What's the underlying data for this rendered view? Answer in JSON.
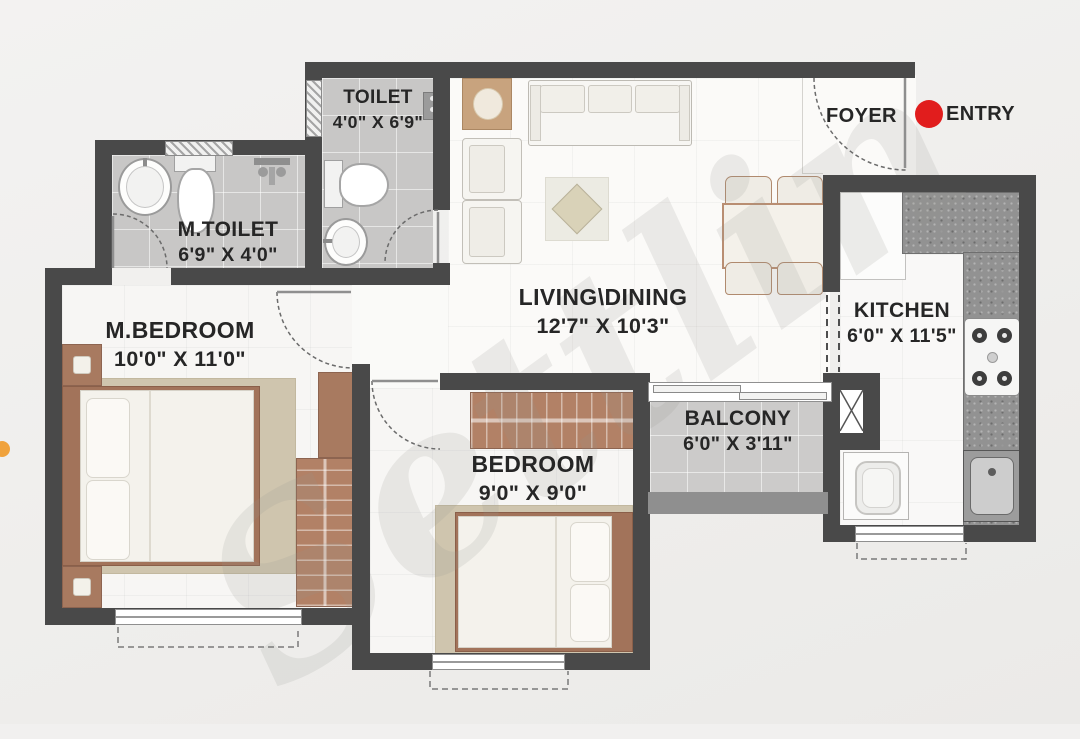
{
  "watermark": "Settlin",
  "labels": {
    "foyer": "FOYER",
    "entry": "ENTRY"
  },
  "rooms": [
    {
      "name": "TOILET",
      "dims": "4'0\" X 6'9\""
    },
    {
      "name": "M.TOILET",
      "dims": "6'9\" X 4'0\""
    },
    {
      "name": "M.BEDROOM",
      "dims": "10'0\" X 11'0\""
    },
    {
      "name": "LIVING\\DINING",
      "dims": "12'7\" X 10'3\""
    },
    {
      "name": "BEDROOM",
      "dims": "9'0\" X 9'0\""
    },
    {
      "name": "BALCONY",
      "dims": "6'0\" X 3'11\""
    },
    {
      "name": "KITCHEN",
      "dims": "6'0\" X 11'5\""
    }
  ],
  "fixtures": [
    "entry-door",
    "foyer",
    "duct-shaft",
    "sofa",
    "armchair",
    "coffee-table",
    "dining-table",
    "dining-chair",
    "double-bed",
    "wardrobe",
    "dresser",
    "nightstand",
    "washbasin",
    "wc-toilet",
    "shower-mixer",
    "kitchen-counter",
    "granite-platform",
    "stove-hob",
    "kitchen-sink",
    "washing-machine",
    "sliding-window",
    "ventilator-window"
  ],
  "colors": {
    "wall": "#494949",
    "parapet": "#8f8f8f",
    "wood": "#a87a60",
    "granite": "#929292",
    "entry-dot": "#e11d1d",
    "marker-dot": "#f0a23c",
    "label-text": "#262626"
  }
}
